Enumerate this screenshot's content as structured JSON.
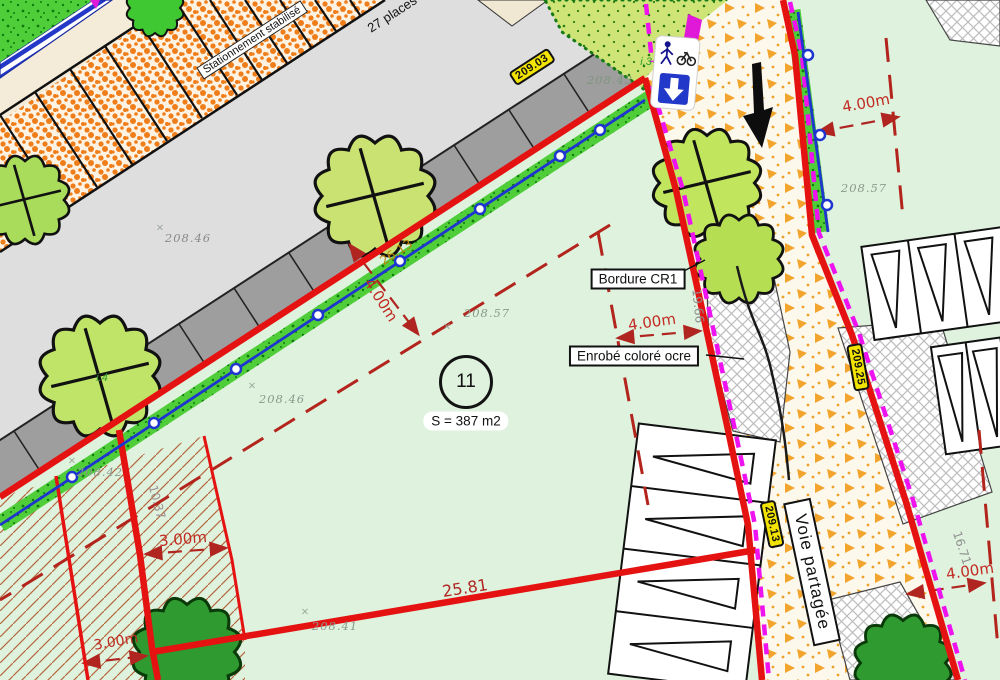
{
  "plan": {
    "parcel": {
      "number": "11",
      "area": "S = 387 m2"
    },
    "labels": {
      "bordure": "Bordure CR1",
      "enrobe": "Enrobé coloré ocre",
      "voie_partagee": "Voie partagée",
      "stationnement": "Stationnement stabilisé",
      "places": "27 places",
      "i3": "i.3",
      "i4": "i.4"
    },
    "level_badges": {
      "top": "209.03",
      "east": "209.25",
      "south": "209.13"
    },
    "spot_levels": {
      "road_top": "208.46",
      "near_sign": "208.43",
      "center": "208.57",
      "center_left": "208.46",
      "east": "208.57",
      "hatch": "208.42",
      "bottom": "208.41"
    },
    "setback_dims": {
      "center": "4.00m",
      "mid_right": "4.00m",
      "top_right": "4.00m",
      "bottom_right": "4.00m",
      "strip": "3.00m",
      "strip_bottom": "3.00m"
    },
    "edge_lengths": {
      "bottom": "25.81",
      "diagonal": "26.13",
      "road_left": "19.66",
      "road_right": "16.71",
      "strip": "10.37"
    },
    "glyphs": {
      "x_marker": "×"
    },
    "colors": {
      "boundary_red": "#e51212",
      "setback_red": "#b3241c",
      "magenta": "#ee12ee",
      "badge_yellow": "#f2e300",
      "fence_blue": "#1f35cf",
      "parcel_green": "#def2de",
      "road_orange": "#f0941e"
    }
  }
}
